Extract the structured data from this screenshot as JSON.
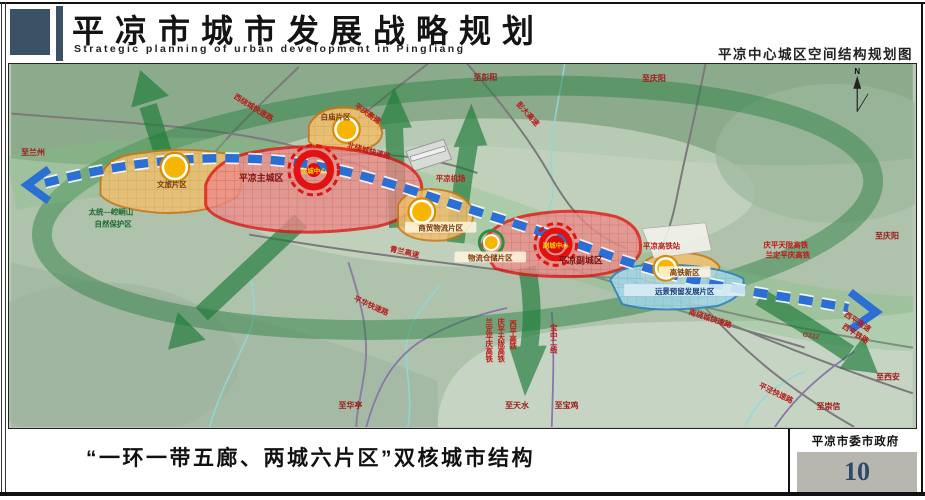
{
  "header": {
    "title_cn": "平凉市城市发展战略规划",
    "title_en": "Strategic planning of urban development in Pingliang",
    "map_subtitle": "平凉中心城区空间结构规划图"
  },
  "footer": {
    "caption": "“一环一带五廊、两城六片区”双核城市结构",
    "agency": "平凉市委市政府",
    "page_number": "10"
  },
  "colors": {
    "brand_bar": "#3b5266",
    "district_red": "#e21212",
    "district_orange": "#d07818",
    "reserve_cyan": "#2f7fc0",
    "belt_blue": "#2b6fd4",
    "corridor_green": "#1c7a38",
    "page_box_gray": "#b7b7af"
  },
  "map": {
    "compass": "N",
    "labels": {
      "to_lanzhou": "至兰州",
      "to_pengyang": "至彭阳",
      "to_qingyang_top": "至庆阳",
      "to_qingyang_right": "至庆阳",
      "to_xian": "至西安",
      "to_chongxin": "至崇信",
      "to_huating": "至华亭",
      "to_tianshui": "至天水",
      "to_baoji": "至宝鸡",
      "pengda_expwy": "彭大高速",
      "pingqing_expwy": "平庆高速",
      "west_ring_rd": "西绕城快速路",
      "north_ring_rd": "北绕城快速路",
      "south_ring_rd": "南绕城快速路",
      "qinglan_expwy": "青兰高速",
      "pinghua_expwy": "平华快速路",
      "pingjing_expwy": "平泾快速路",
      "g312": "G312",
      "xiping_expwy": "西平高速",
      "xiping_rail": "西平铁路",
      "qingping_tianlong_hsr": "庆平天陇高铁",
      "landing_pingqing_hsr": "兰定平庆高铁",
      "xiping_hsr": "西平高铁",
      "baozhong_line2": "宝中二线",
      "hsr_station": "平凉高铁站",
      "airport": "平凉机场",
      "nature_reserve_1": "太统—崆峒山",
      "nature_reserve_2": "自然保护区",
      "baimiao_district": "白庙片区",
      "wenlv_district": "文旅片区",
      "main_city": "平凉主城区",
      "main_center": "主城中心",
      "shangmao_district": "商贸物流片区",
      "cangchu_district": "物流仓储片区",
      "sub_city": "平凉副城区",
      "sub_center": "副城中心",
      "hsr_district": "高铁新区",
      "future_reserve_district": "远景预留发展片区"
    }
  }
}
